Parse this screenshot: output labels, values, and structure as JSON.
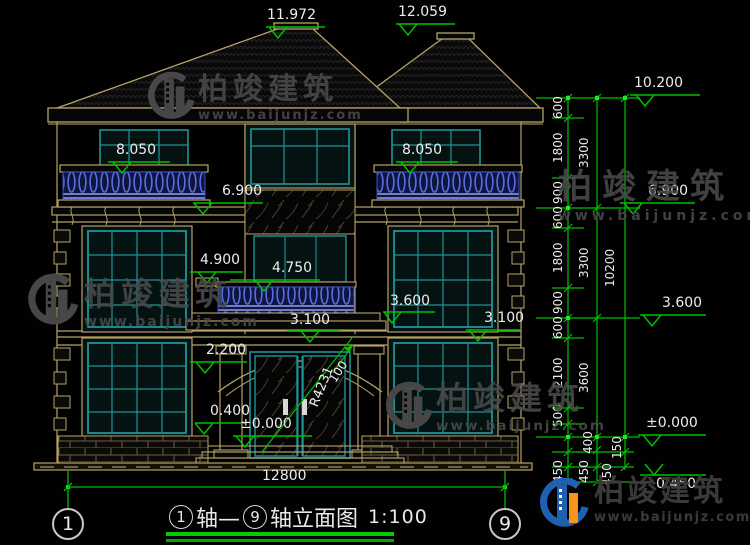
{
  "drawing": {
    "title": {
      "axis_start": "1",
      "connector": "轴—",
      "axis_end": "9",
      "name": "轴立面图",
      "scale": "1:100"
    },
    "axis_bubbles": {
      "left": "1",
      "right": "9"
    }
  },
  "elevations": {
    "ridge_left": "11.972",
    "ridge_right": "12.059",
    "roof_right": "10.200",
    "balcony_left": "8.050",
    "balcony_right": "8.050",
    "cornice_left": "6.900",
    "cornice_right": "6.900",
    "ledge_left": "4.900",
    "balcony_center": "4.750",
    "porch_top": "3.600",
    "floor2_right_chain": "3.600",
    "band_center": "3.100",
    "band_right": "3.100",
    "door_head": "2.200",
    "window_sill": "0.400",
    "ground_center": "±0.000",
    "ground_right": "±0.000",
    "below_grade_right": "0.450"
  },
  "dimensions": {
    "overall_width": "12800",
    "right_chain_inner": [
      "600",
      "1800",
      "900",
      "600",
      "1800",
      "900",
      "600",
      "2100",
      "500",
      "450"
    ],
    "right_chain_middle": [
      "3300",
      "3300",
      "3600",
      "400",
      "450"
    ],
    "right_chain_outer": [
      "10200",
      "150",
      "450"
    ]
  },
  "annotations": {
    "door_arc_radius": "R4231",
    "arc_dim": "100"
  },
  "watermark": {
    "brand": "柏竣建筑",
    "website": "www.baijunjz.com"
  },
  "logo": {
    "brand": "柏竣建筑",
    "website": "www.baijunjz.com"
  },
  "colors": {
    "background": "#000000",
    "cad_tan": "#b7a267",
    "cad_teal": "#1f9396",
    "cad_green": "#00c000",
    "text_white": "#ededed",
    "balustrade_blue": "#5a6ee0",
    "watermark_gray": "#4a4a4a",
    "logo_blue": "#2060b0",
    "logo_orange": "#f7941d"
  }
}
